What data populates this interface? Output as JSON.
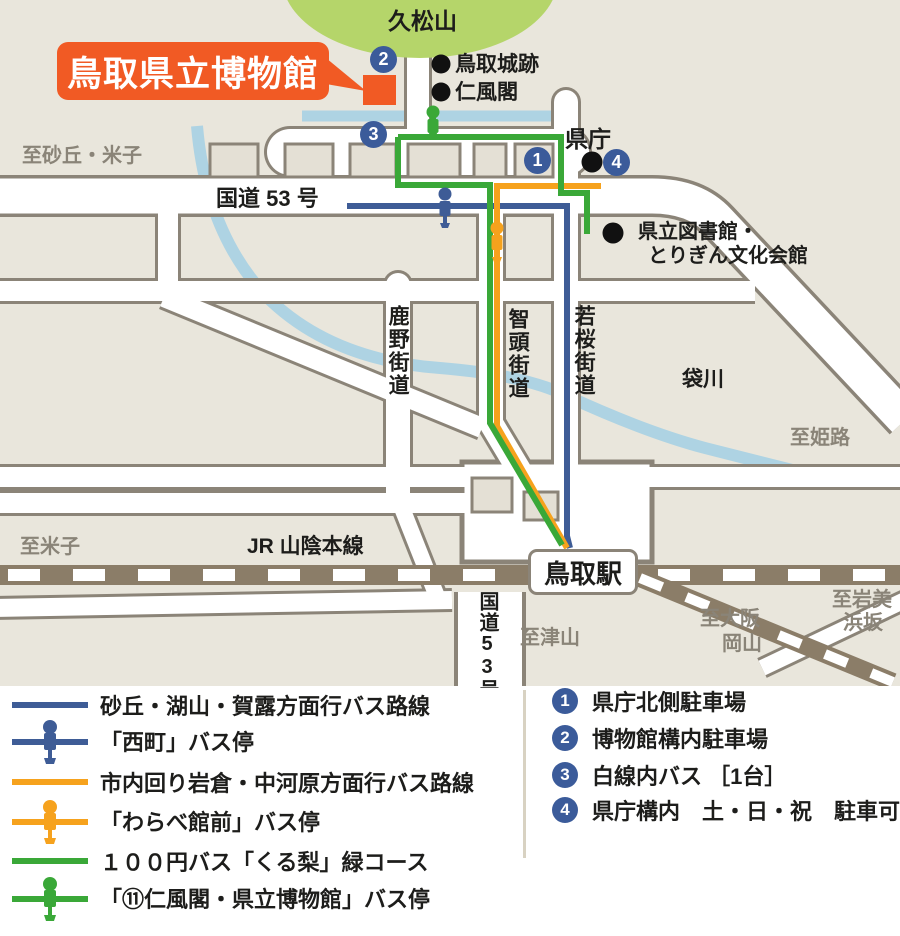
{
  "map": {
    "mountain_label": "久松山",
    "museum_label": "鳥取県立博物館",
    "poi": {
      "castle": "鳥取城跡",
      "jinpukaku": "仁風閣",
      "kencho": "県庁",
      "library_line1": "県立図書館・",
      "library_line2": "とりぎん文化会館",
      "fukurogawa": "袋川"
    },
    "roads": {
      "route53": "国道 53 号",
      "route53_vertical": "国道53号",
      "shikano": "鹿野街道",
      "chizu": "智頭街道",
      "wakasa": "若桜街道",
      "jr_line": "JR 山陰本線"
    },
    "directions": {
      "sakyu_yonago": "至砂丘・米子",
      "himeji": "至姫路",
      "yonago": "至米子",
      "tsuyama": "至津山",
      "osaka_line1": "至大阪",
      "osaka_line2": "岡山",
      "iwami_line1": "至岩美",
      "iwami_line2": "浜坂"
    },
    "station": "鳥取駅",
    "markers": [
      "1",
      "2",
      "3",
      "4"
    ]
  },
  "legend": {
    "routes": [
      {
        "type": "line",
        "color": "#3e5c96",
        "label": "砂丘・湖山・賀露方面行バス路線"
      },
      {
        "type": "stop",
        "color": "#3e5c96",
        "label": "「西町」バス停"
      },
      {
        "type": "line",
        "color": "#f6a21d",
        "label": "市内回り岩倉・中河原方面行バス路線"
      },
      {
        "type": "stop",
        "color": "#f6a21d",
        "label": "「わらべ館前」バス停"
      },
      {
        "type": "line",
        "color": "#3aa838",
        "label": "１００円バス「くる梨」緑コース"
      },
      {
        "type": "stop",
        "color": "#3aa838",
        "label": "「⑪仁風閣・県立博物館」バス停"
      }
    ],
    "parking": [
      {
        "num": "1",
        "label": "県庁北側駐車場"
      },
      {
        "num": "2",
        "label": "博物館構内駐車場"
      },
      {
        "num": "3",
        "label": "白線内バス ［1台］"
      },
      {
        "num": "4",
        "label": "県庁構内　土・日・祝　駐車可"
      }
    ]
  },
  "colors": {
    "background": "#e9e6dc",
    "block_fill": "#e4e0d5",
    "road_casing": "#8b8478",
    "road_fill": "#ffffff",
    "river": "#aed3e3",
    "railway": "#8b7d68",
    "route_blue": "#3e5c96",
    "route_orange": "#f6a21d",
    "route_green": "#3aa838",
    "marker_blue": "#3b5b9a",
    "museum_orange": "#f15a24",
    "hill_green": "#b5d56a",
    "gray_text": "#8a8478"
  }
}
